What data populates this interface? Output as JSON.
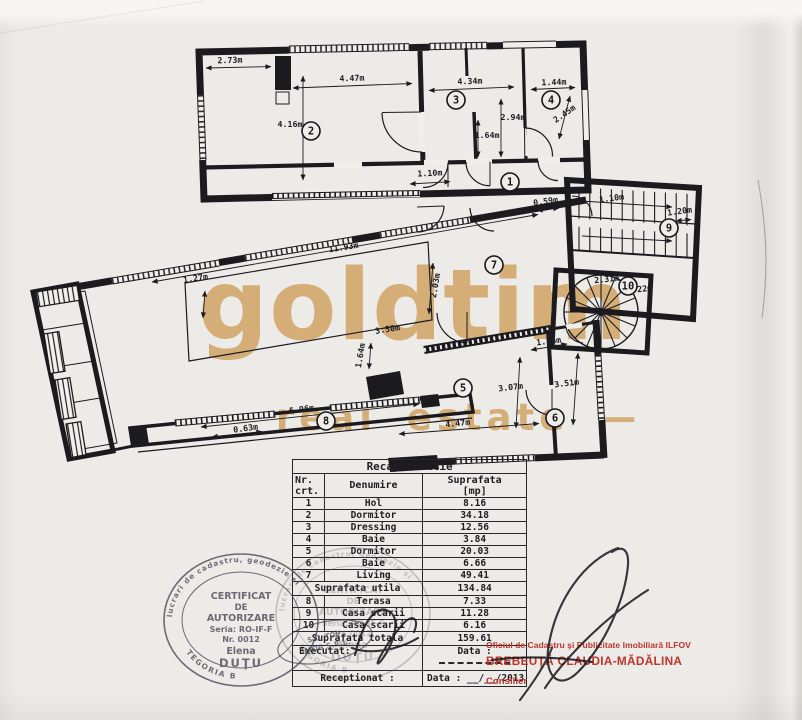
{
  "watermark": {
    "word": "goldtim",
    "tagline": "— real estate —",
    "color": "#d1a566"
  },
  "plan": {
    "room_numbers": [
      {
        "n": "1",
        "x": 510,
        "y": 182
      },
      {
        "n": "2",
        "x": 311,
        "y": 131
      },
      {
        "n": "3",
        "x": 456,
        "y": 100
      },
      {
        "n": "4",
        "x": 551,
        "y": 100
      },
      {
        "n": "5",
        "x": 463,
        "y": 388
      },
      {
        "n": "6",
        "x": 555,
        "y": 418
      },
      {
        "n": "7",
        "x": 494,
        "y": 265
      },
      {
        "n": "8",
        "x": 326,
        "y": 421
      },
      {
        "n": "9",
        "x": 669,
        "y": 228
      },
      {
        "n": "10",
        "x": 628,
        "y": 286
      }
    ],
    "dimensions": [
      {
        "t": "2.73m",
        "x": 230,
        "y": 63,
        "r": -2
      },
      {
        "t": "4.47m",
        "x": 352,
        "y": 81,
        "r": -2
      },
      {
        "t": "4.34m",
        "x": 470,
        "y": 84,
        "r": -2
      },
      {
        "t": "1.44m",
        "x": 554,
        "y": 85,
        "r": -2
      },
      {
        "t": "4.16m",
        "x": 290,
        "y": 127,
        "r": 0
      },
      {
        "t": "2.94m",
        "x": 513,
        "y": 120,
        "r": 0
      },
      {
        "t": "1.64m",
        "x": 487,
        "y": 138,
        "r": 0
      },
      {
        "t": "2.45m",
        "x": 566,
        "y": 116,
        "r": -35
      },
      {
        "t": "1.10m",
        "x": 430,
        "y": 176,
        "r": -3
      },
      {
        "t": "0.59m",
        "x": 546,
        "y": 204,
        "r": -8
      },
      {
        "t": "1.10m",
        "x": 612,
        "y": 201,
        "r": -8
      },
      {
        "t": "1.20m",
        "x": 680,
        "y": 214,
        "r": -8
      },
      {
        "t": "11.93m",
        "x": 344,
        "y": 250,
        "r": -9
      },
      {
        "t": "1.27m",
        "x": 196,
        "y": 281,
        "r": -9
      },
      {
        "t": "2.03m",
        "x": 438,
        "y": 286,
        "r": -80
      },
      {
        "t": "2.31m",
        "x": 607,
        "y": 282,
        "r": -6
      },
      {
        "t": "2.22m",
        "x": 640,
        "y": 292,
        "r": -6
      },
      {
        "t": "3.50m",
        "x": 388,
        "y": 332,
        "r": -9
      },
      {
        "t": "1.64m",
        "x": 363,
        "y": 356,
        "r": -80
      },
      {
        "t": "1.86m",
        "x": 549,
        "y": 344,
        "r": -7
      },
      {
        "t": "3.07m",
        "x": 511,
        "y": 390,
        "r": -7
      },
      {
        "t": "3.51m",
        "x": 567,
        "y": 386,
        "r": -7
      },
      {
        "t": "5.96m",
        "x": 302,
        "y": 412,
        "r": -8
      },
      {
        "t": "0.63m",
        "x": 246,
        "y": 431,
        "r": -8
      },
      {
        "t": "4.47m",
        "x": 458,
        "y": 426,
        "r": -6
      }
    ]
  },
  "table": {
    "title": "Recapitulatie",
    "header": {
      "nr": "Nr.",
      "crt": "crt.",
      "name": "Denumire",
      "area": "Suprafata",
      "unit": "[mp]"
    },
    "rows": [
      [
        "1",
        "Hol",
        "8.16"
      ],
      [
        "2",
        "Dormitor",
        "34.18"
      ],
      [
        "3",
        "Dressing",
        "12.56"
      ],
      [
        "4",
        "Baie",
        "3.84"
      ],
      [
        "5",
        "Dormitor",
        "20.03"
      ],
      [
        "6",
        "Baie",
        "6.66"
      ],
      [
        "7",
        "Living",
        "49.41"
      ]
    ],
    "utila": {
      "label": "Suprafata utila",
      "value": "134.84"
    },
    "rows2": [
      [
        "8",
        "Terasa",
        "7.33"
      ],
      [
        "9",
        "Casa scarii",
        "11.28"
      ],
      [
        "10",
        "Casa scarii",
        "6.16"
      ]
    ],
    "totala": {
      "label": "Suprafata totala",
      "value": "159.61"
    },
    "executat": {
      "label": "Executat:",
      "data": "Data :"
    },
    "receptionat": {
      "label": "Receptionat :",
      "data": "Data : __/__/2013"
    }
  },
  "stamps": {
    "round": {
      "ring": "autorizata de ANCPI sa execute lucrari de cadastru, geodezie si",
      "l1": "CERTIFICAT",
      "l2": "DE",
      "l3": "AUTORIZARE",
      "l4": "Seria: RO-IF-F",
      "l5": "Nr. 0012",
      "l6": "Elena",
      "l7": "DUŢU",
      "bottom": "CATEGORIA B"
    },
    "company": {
      "l1": "S.C. TOP",
      "l2": "IMOB S.R.L."
    }
  },
  "registry": {
    "office": "Oficiul de Cadastru şi Publicitate Imobiliară ILFOV",
    "name": "BREBEUŢĂ CLAUDIA-MĂDĂLINA",
    "role": "Consilier"
  }
}
